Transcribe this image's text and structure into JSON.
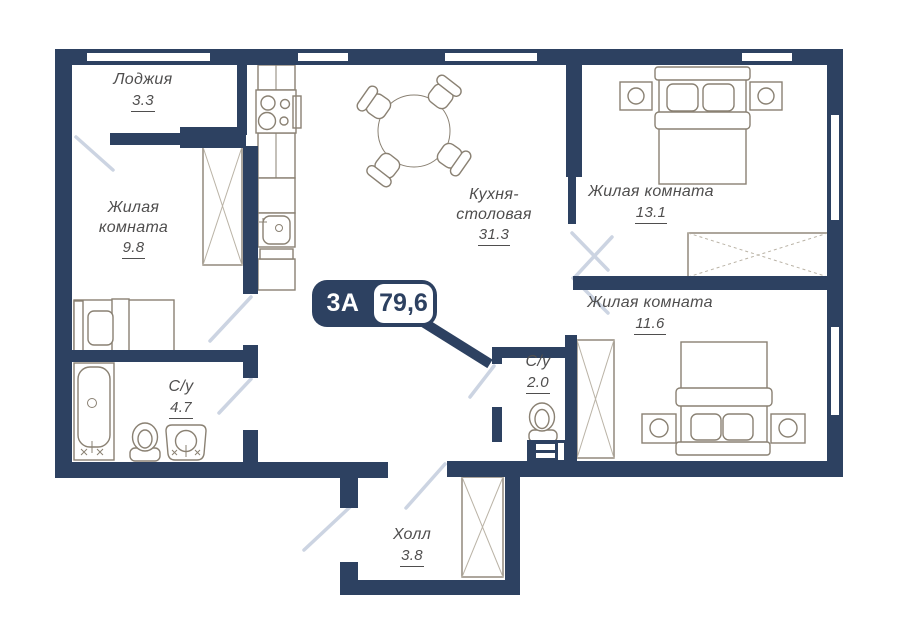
{
  "plan": {
    "badge": {
      "type": "3А",
      "area": "79,6"
    },
    "rooms": [
      {
        "key": "loggia",
        "name": "Лоджия",
        "area": "3.3"
      },
      {
        "key": "living-room-1",
        "name": "Жилая комната",
        "area": "9.8"
      },
      {
        "key": "kitchen-dining",
        "name": "Кухня-столовая",
        "area": "31.3"
      },
      {
        "key": "living-room-2",
        "name": "Жилая комната",
        "area": "13.1"
      },
      {
        "key": "living-room-3",
        "name": "Жилая комната",
        "area": "11.6"
      },
      {
        "key": "bathroom-1",
        "name": "С/у",
        "area": "4.7"
      },
      {
        "key": "bathroom-2",
        "name": "С/у",
        "area": "2.0"
      },
      {
        "key": "hall",
        "name": "Холл",
        "area": "3.8"
      }
    ]
  },
  "colors": {
    "wall": "#2d4161",
    "swing": "#ccd4e2",
    "furniture": "#8a8173",
    "label": "#4f4e4e"
  }
}
